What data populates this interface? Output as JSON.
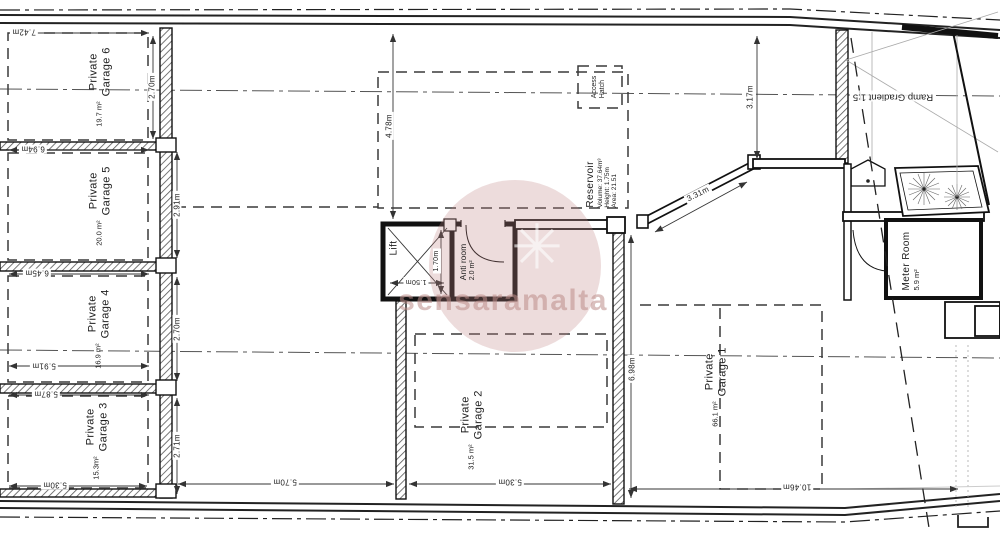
{
  "garages": {
    "g1": {
      "l1": "Private",
      "l2": "Garage 1",
      "area": "66.1 m²"
    },
    "g2": {
      "l1": "Private",
      "l2": "Garage 2",
      "area": "31.5 m²"
    },
    "g3": {
      "l1": "Private",
      "l2": "Garage 3",
      "area": "15.3m²"
    },
    "g4": {
      "l1": "Private",
      "l2": "Garage 4",
      "area": "16.9 m²"
    },
    "g5": {
      "l1": "Private",
      "l2": "Garage 5",
      "area": "20.0 m²"
    },
    "g6": {
      "l1": "Private",
      "l2": "Garage 6",
      "area": "19.7 m²"
    }
  },
  "rooms": {
    "lift": {
      "name": "Lift"
    },
    "anti_room": {
      "name": "Anti room",
      "area": "2.0 m²"
    },
    "meter_room": {
      "name": "Meter Room",
      "area": "5.9 m²"
    },
    "reservoir": {
      "name": "Reservoir",
      "volume": "Volume: 37.64m³",
      "height": "Height: 1.75m",
      "area": "Area: 21.51"
    },
    "access_hatch": {
      "l1": "Access",
      "l2": "Hatch"
    }
  },
  "ramp": {
    "label": "Ramp Gradient 1:5"
  },
  "dims": {
    "d742": "7.42m",
    "d694": "6.94m",
    "d645": "6.45m",
    "d591": "5.91m",
    "d587": "5.87m",
    "d530l": "5.30m",
    "d270a": "2.70m",
    "d291": "2.91m",
    "d270b": "2.70m",
    "d271": "2.71m",
    "d478": "4.78m",
    "d170": "1.70m",
    "d150": "1.50m",
    "d331": "3.31m",
    "d317": "3.17m",
    "d698": "6.98m",
    "d570": "5.70m",
    "d530g2": "5.30m",
    "d1046": "10.46m"
  },
  "watermark": {
    "text": "sensaramalta",
    "logo_glyph": "✳",
    "color": "#c08080"
  }
}
